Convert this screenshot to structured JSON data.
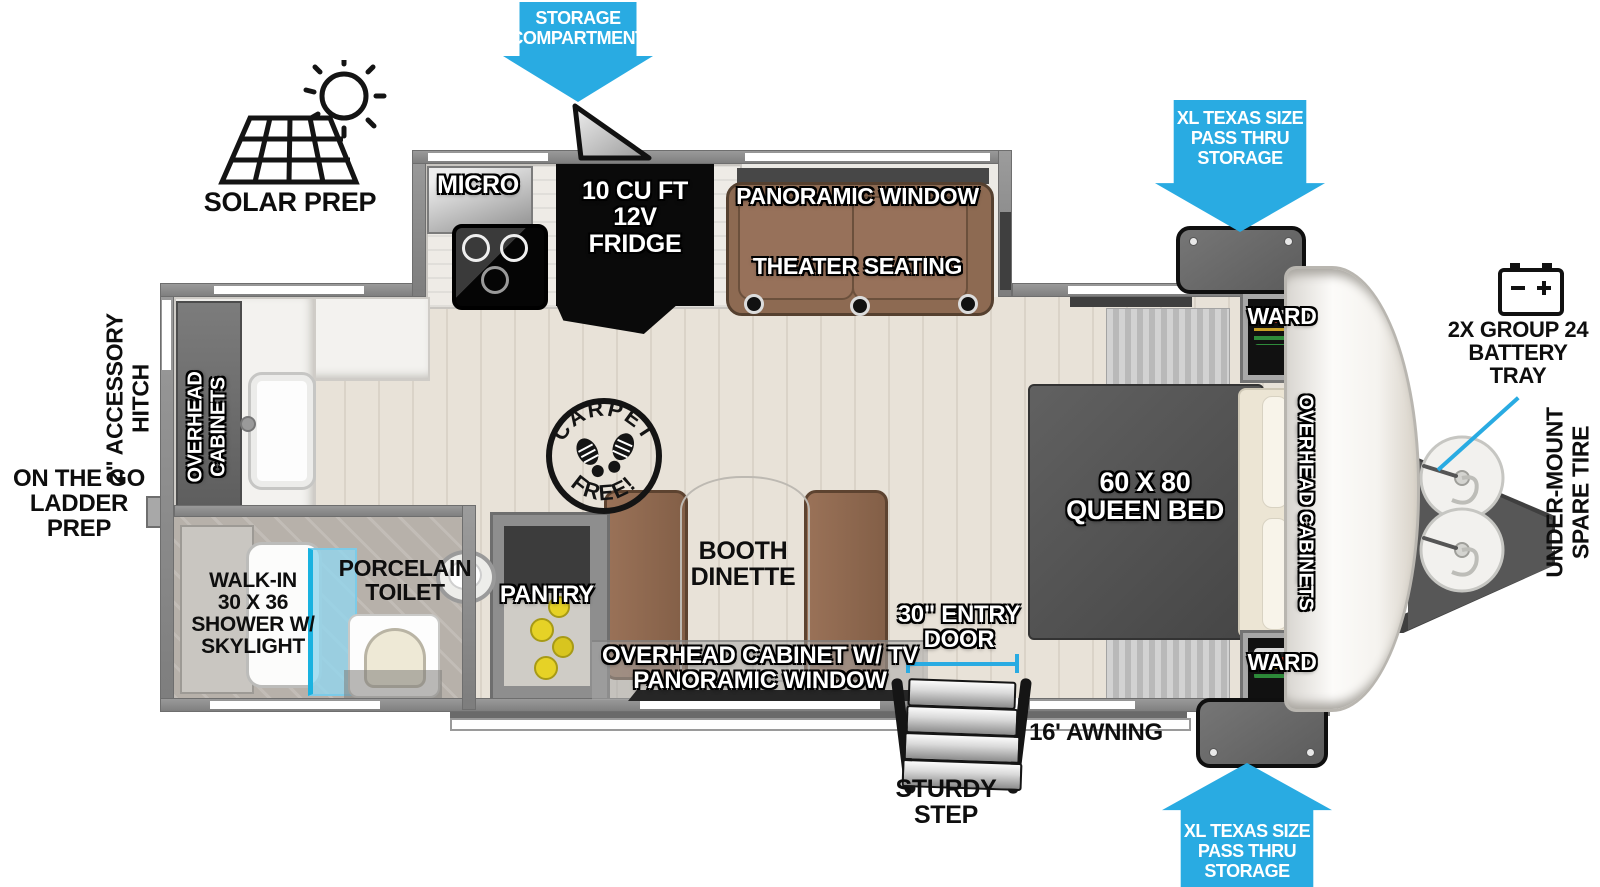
{
  "colors": {
    "arrow_blue": "#29ABE2",
    "wall_gray": "#8c8c8c",
    "seat_brown": "#8d6a52",
    "bed_gray": "#525252"
  },
  "exterior": {
    "solar_prep": {
      "label": "SOLAR PREP"
    },
    "storage_compartment": {
      "line1": "STORAGE",
      "line2": "COMPARTMENT"
    },
    "pass_thru_top": {
      "line1": "XL TEXAS SIZE",
      "line2": "PASS THRU",
      "line3": "STORAGE"
    },
    "pass_thru_bottom": {
      "line1": "XL TEXAS SIZE",
      "line2": "PASS THRU",
      "line3": "STORAGE"
    },
    "battery_tray": {
      "line1": "2X GROUP 24",
      "line2": "BATTERY",
      "line3": "TRAY"
    },
    "spare_tire": {
      "line1": "UNDER-MOUNT",
      "line2": "SPARE TIRE"
    },
    "accessory_hitch": {
      "line1": "2\" ACCESSORY",
      "line2": "HITCH"
    },
    "ladder_prep": {
      "line1": "ON THE GO",
      "line2": "LADDER PREP"
    },
    "entry_door": {
      "line1": "30\" ENTRY",
      "line2": "DOOR"
    },
    "awning": {
      "label": "16' AWNING"
    },
    "sturdy_step": {
      "line1": "STURDY",
      "line2": "STEP"
    }
  },
  "interior": {
    "micro": "MICRO",
    "fridge": {
      "line1": "10 CU FT",
      "line2": "12V",
      "line3": "FRIDGE"
    },
    "panoramic_window_top": "PANORAMIC WINDOW",
    "theater_seating": "THEATER SEATING",
    "ward_top": "WARD",
    "ward_bottom": "WARD",
    "overhead_cabinets_bedroom": "OVERHEAD CABINETS",
    "overhead_cabinets_rear": {
      "line1": "OVERHEAD",
      "line2": "CABINETS"
    },
    "queen_bed": {
      "line1": "60 X 80",
      "line2": "QUEEN BED"
    },
    "carpet_free": {
      "top": "CARPET",
      "bottom": "FREE!"
    },
    "booth_dinette": {
      "line1": "BOOTH",
      "line2": "DINETTE"
    },
    "overhead_cabinet_tv": "OVERHEAD CABINET W/ TV",
    "panoramic_window_bottom": "PANORAMIC WINDOW",
    "pantry": "PANTRY",
    "porcelain_toilet": {
      "line1": "PORCELAIN",
      "line2": "TOILET"
    },
    "shower": {
      "line1": "WALK-IN",
      "line2": "30 X 36",
      "line3": "SHOWER W/",
      "line4": "SKYLIGHT"
    }
  }
}
